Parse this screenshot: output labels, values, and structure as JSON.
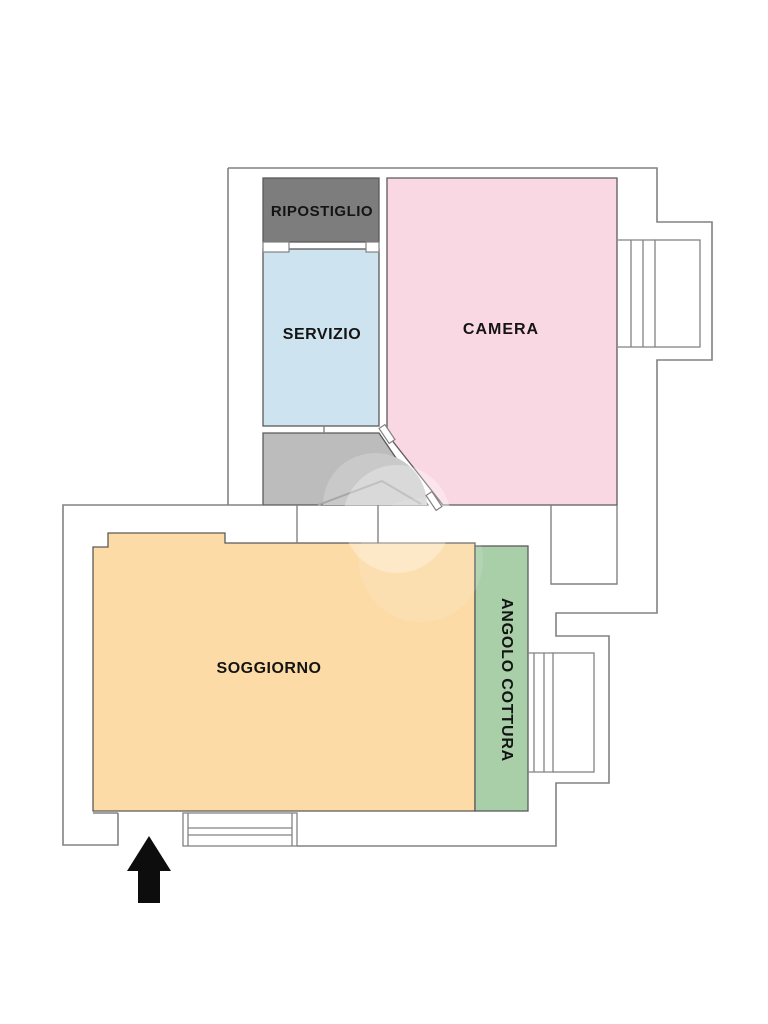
{
  "page": {
    "background": "#ffffff"
  },
  "plan": {
    "wall_color": "#828282",
    "room_outline_color": "#5a5a5a",
    "label_color": "#141414",
    "arrow_color": "#0d0d0d",
    "rooms": {
      "ripostiglio": {
        "label": "RIPOSTIGLIO",
        "color": "#7d7d7d"
      },
      "servizio": {
        "label": "SERVIZIO",
        "color": "#cee3f0"
      },
      "camera": {
        "label": "CAMERA",
        "color": "#f9d8e3"
      },
      "disimpegno": {
        "color": "#bcbcbc"
      },
      "soggiorno": {
        "label": "SOGGIORNO",
        "color": "#fcdba6"
      },
      "angolo_cottura": {
        "label": "ANGOLO COTTURA",
        "color": "#a9cfa9"
      }
    },
    "icons": {
      "entrance_arrow": "entrance-arrow"
    }
  }
}
